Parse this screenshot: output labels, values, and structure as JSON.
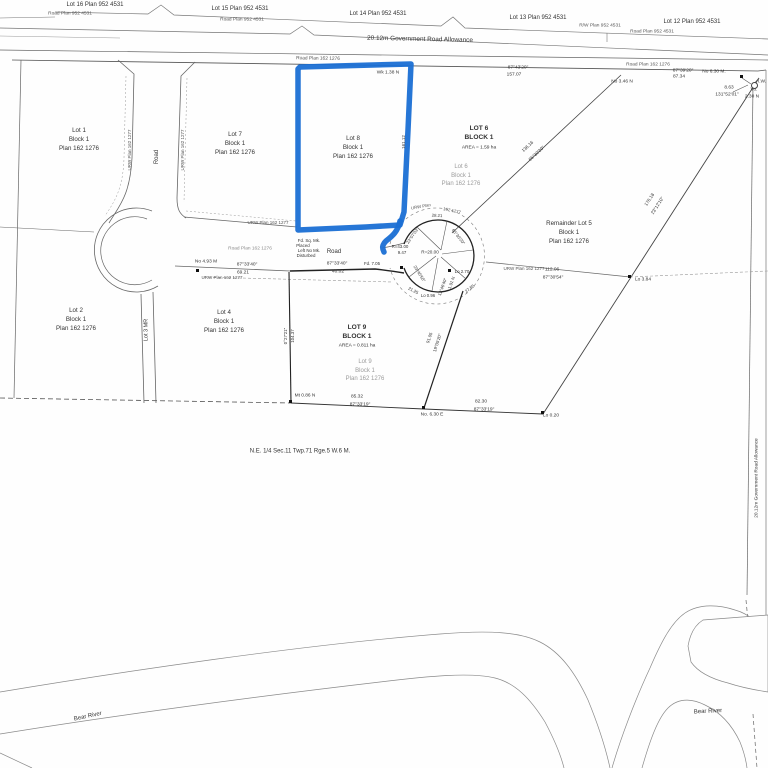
{
  "map_type": "subdivision survey plan",
  "highlight_color": "#1a6fd4",
  "line_color": "#555555",
  "faded_text_color": "#9b9b9b",
  "parcels": [
    {
      "key": "lot-1",
      "x": 79,
      "y": 140,
      "s": 6.2,
      "lines": [
        "Lot 1",
        "Block 1",
        "Plan 162 1276"
      ]
    },
    {
      "key": "lot-7",
      "x": 235,
      "y": 144,
      "s": 6.2,
      "lines": [
        "Lot 7",
        "Block 1",
        "Plan 162 1276"
      ]
    },
    {
      "key": "lot-8-highlighted",
      "x": 353,
      "y": 148,
      "s": 6.2,
      "lines": [
        "Lot 8",
        "Block 1",
        "Plan 162 1276"
      ]
    },
    {
      "key": "lot-6-bold",
      "x": 479,
      "y": 133,
      "s": 6.6,
      "bold": true,
      "lines": [
        "LOT 6",
        "BLOCK 1"
      ]
    },
    {
      "key": "lot-6-faded",
      "x": 461,
      "y": 176,
      "s": 6,
      "c": "#9b9b9b",
      "lines": [
        "Lot 6",
        "Block 1",
        "Plan 162 1276"
      ]
    },
    {
      "key": "remainder-lot-5",
      "x": 569,
      "y": 233,
      "s": 6.2,
      "lines": [
        "Remainder Lot 5",
        "Block 1",
        "Plan 162 1276"
      ]
    },
    {
      "key": "lot-2",
      "x": 76,
      "y": 320,
      "s": 6.2,
      "lines": [
        "Lot 2",
        "Block 1",
        "Plan 162 1276"
      ]
    },
    {
      "key": "lot-4",
      "x": 224,
      "y": 322,
      "s": 6.2,
      "lines": [
        "Lot 4",
        "Block 1",
        "Plan 162 1276"
      ]
    },
    {
      "key": "lot-9-bold",
      "x": 357,
      "y": 332,
      "s": 6.6,
      "bold": true,
      "lines": [
        "LOT 9",
        "BLOCK 1"
      ]
    },
    {
      "key": "lot-9-faded",
      "x": 365,
      "y": 371,
      "s": 6,
      "c": "#9b9b9b",
      "lines": [
        "Lot 9",
        "Block 1",
        "Plan 162 1276"
      ]
    },
    {
      "key": "quarter-section-label",
      "x": 300,
      "y": 452,
      "s": 6,
      "lines": [
        "N.E. 1/4 Sec.11 Twp.71 Rge.5 W.6 M."
      ]
    },
    {
      "key": "bear-river-left",
      "x": 88,
      "y": 717,
      "s": 6,
      "r": -12,
      "lines": [
        "Bear River"
      ]
    },
    {
      "key": "bear-river-right",
      "x": 708,
      "y": 712,
      "s": 6,
      "r": -3,
      "lines": [
        "Bear River"
      ]
    }
  ],
  "annotations": [
    {
      "n": "top-lot-label",
      "t": "Lot 16 Plan 952 4531",
      "x": 95,
      "y": 5,
      "s": 6
    },
    {
      "n": "top-lot-label",
      "t": "Lot 15 Plan 952 4531",
      "x": 240,
      "y": 9,
      "s": 6
    },
    {
      "n": "top-lot-label",
      "t": "Lot 14 Plan 952 4531",
      "x": 378,
      "y": 14,
      "s": 6
    },
    {
      "n": "top-lot-label",
      "t": "Lot 13 Plan 952 4531",
      "x": 538,
      "y": 18,
      "s": 6
    },
    {
      "n": "top-lot-label",
      "t": "Lot 12 Plan 952 4531",
      "x": 692,
      "y": 22,
      "s": 6
    },
    {
      "n": "road-plan-label",
      "t": "Road Plan 952 4531",
      "x": 70,
      "y": 15,
      "s": 4.8,
      "c": "#555"
    },
    {
      "n": "road-plan-label",
      "t": "Road Plan 952 4531",
      "x": 242,
      "y": 21,
      "s": 4.8,
      "c": "#555"
    },
    {
      "n": "road-plan-label",
      "t": "R/W Plan 952 4531",
      "x": 600,
      "y": 27,
      "s": 4.8,
      "c": "#555"
    },
    {
      "n": "road-plan-label",
      "t": "Road Plan 952 4531",
      "x": 652,
      "y": 33,
      "s": 4.8,
      "c": "#555"
    },
    {
      "n": "road-allowance-label",
      "t": "20.12m Government Road Allowance",
      "x": 420,
      "y": 40,
      "s": 6.4,
      "r": 1.2
    },
    {
      "n": "road-plan-label",
      "t": "Road Plan 162 1276",
      "x": 318,
      "y": 60,
      "s": 4.8,
      "c": "#555",
      "r": 1
    },
    {
      "n": "survey-note",
      "t": "Wk 1.38 N",
      "x": 388,
      "y": 74,
      "s": 4.8
    },
    {
      "n": "bearing",
      "t": "87°43'20\"",
      "x": 518,
      "y": 69,
      "s": 4.8
    },
    {
      "n": "distance",
      "t": "157.07",
      "x": 514,
      "y": 76,
      "s": 4.8
    },
    {
      "n": "road-plan-label",
      "t": "Road Plan 162 1276",
      "x": 648,
      "y": 66,
      "s": 4.8,
      "c": "#555"
    },
    {
      "n": "bearing",
      "t": "87°39'20\"",
      "x": 683,
      "y": 72,
      "s": 4.8
    },
    {
      "n": "distance",
      "t": "87.34",
      "x": 679,
      "y": 78,
      "s": 4.8
    },
    {
      "n": "survey-note",
      "t": "No 3.46 N",
      "x": 622,
      "y": 83,
      "s": 4.8
    },
    {
      "n": "survey-note",
      "t": "No 6.30 M.",
      "x": 714,
      "y": 73,
      "s": 4.8
    },
    {
      "n": "distance",
      "t": "8.63",
      "x": 729,
      "y": 89,
      "s": 4.8
    },
    {
      "n": "bearing",
      "t": "131°52'01\"",
      "x": 727,
      "y": 96,
      "s": 4.8
    },
    {
      "n": "survey-note",
      "t": "I.W.",
      "x": 762,
      "y": 83,
      "s": 4.8
    },
    {
      "n": "survey-note",
      "t": "Vo.",
      "x": 754,
      "y": 91,
      "s": 4.8
    },
    {
      "n": "survey-note",
      "t": "2.30 N",
      "x": 752,
      "y": 98,
      "s": 4.8
    },
    {
      "n": "road-label",
      "t": "Road",
      "x": 157,
      "y": 157,
      "s": 6,
      "r": -90
    },
    {
      "n": "urw-label",
      "t": "URW Plan 162 1277",
      "x": 130,
      "y": 150,
      "s": 4.5,
      "r": -90,
      "c": "#555"
    },
    {
      "n": "urw-label",
      "t": "URW Plan 162 1277",
      "x": 183,
      "y": 150,
      "s": 4.5,
      "r": -90,
      "c": "#555"
    },
    {
      "n": "distance",
      "t": "161.12",
      "x": 404,
      "y": 142,
      "s": 4.5,
      "r": -90
    },
    {
      "n": "urw-label",
      "t": "URW Plan 162 1277",
      "x": 268,
      "y": 223,
      "s": 4.5,
      "c": "#555"
    },
    {
      "n": "road-plan-label",
      "t": "Road Plan 162 1276",
      "x": 250,
      "y": 250,
      "s": 4.8,
      "c": "#8a8a8a"
    },
    {
      "n": "road-label",
      "t": "Road",
      "x": 334,
      "y": 252,
      "s": 6
    },
    {
      "n": "survey-note",
      "t": "Fd. Sq. Mk.",
      "x": 309,
      "y": 241,
      "s": 4.4
    },
    {
      "n": "survey-note",
      "t": "Placed",
      "x": 303,
      "y": 246,
      "s": 4.4
    },
    {
      "n": "survey-note",
      "t": "Left No Mk.",
      "x": 309,
      "y": 251,
      "s": 4.4
    },
    {
      "n": "survey-note",
      "t": "Disturbed",
      "x": 306,
      "y": 256,
      "s": 4.4
    },
    {
      "n": "survey-note",
      "t": "No 4.93 M",
      "x": 206,
      "y": 263,
      "s": 4.8
    },
    {
      "n": "bearing",
      "t": "87°33'40\"",
      "x": 247,
      "y": 266,
      "s": 4.8
    },
    {
      "n": "distance",
      "t": "69.21",
      "x": 243,
      "y": 274,
      "s": 4.8
    },
    {
      "n": "urw-label",
      "t": "URW Plan 162 1277",
      "x": 222,
      "y": 278,
      "s": 4.5,
      "c": "#555"
    },
    {
      "n": "bearing",
      "t": "87°33'40\"",
      "x": 337,
      "y": 265,
      "s": 4.8
    },
    {
      "n": "distance",
      "t": "40.02",
      "x": 338,
      "y": 273,
      "s": 4.8
    },
    {
      "n": "survey-note",
      "t": "Fd. 7.05",
      "x": 372,
      "y": 264,
      "s": 4.4
    },
    {
      "n": "radius-label",
      "t": "R=43.00",
      "x": 400,
      "y": 247,
      "s": 4.4
    },
    {
      "n": "distance",
      "t": "9.47",
      "x": 402,
      "y": 253,
      "s": 4.4
    },
    {
      "n": "urw-label",
      "t": "URW Plan",
      "x": 421,
      "y": 207,
      "s": 4.3,
      "r": -10,
      "c": "#555"
    },
    {
      "n": "urw-label",
      "t": "162 1277",
      "x": 452,
      "y": 211,
      "s": 4.3,
      "r": 12,
      "c": "#555"
    },
    {
      "n": "distance",
      "t": "28.21",
      "x": 437,
      "y": 216,
      "s": 4.3,
      "r": 3
    },
    {
      "n": "bearing",
      "t": "23°07'03\"",
      "x": 413,
      "y": 236,
      "s": 4.3,
      "r": -55
    },
    {
      "n": "bearing",
      "t": "65°30'20\"",
      "x": 458,
      "y": 237,
      "s": 4.3,
      "r": 52
    },
    {
      "n": "radius-label",
      "t": "R=20.00",
      "x": 430,
      "y": 253,
      "s": 4.6
    },
    {
      "n": "survey-note",
      "t": "Lo 2.70",
      "x": 462,
      "y": 272,
      "s": 4.4
    },
    {
      "n": "bearing",
      "t": "23°40'50\"",
      "x": 419,
      "y": 274,
      "s": 4.3,
      "r": 58
    },
    {
      "n": "bearing",
      "t": "12°46'40\"",
      "x": 443,
      "y": 287,
      "s": 4.3,
      "r": -70
    },
    {
      "n": "survey-note",
      "t": "1.91 N",
      "x": 452,
      "y": 283,
      "s": 4.3,
      "r": -70
    },
    {
      "n": "distance",
      "t": "21.25",
      "x": 413,
      "y": 291,
      "s": 4.3,
      "r": 28
    },
    {
      "n": "distance",
      "t": "27.85",
      "x": 470,
      "y": 289,
      "s": 4.3,
      "r": -38
    },
    {
      "n": "survey-note",
      "t": "Lo 0.96",
      "x": 428,
      "y": 296,
      "s": 4.3
    },
    {
      "n": "urw-label",
      "t": "URW Plan 162 1277",
      "x": 524,
      "y": 269,
      "s": 4.5,
      "c": "#555"
    },
    {
      "n": "distance",
      "t": "112.06",
      "x": 552,
      "y": 271,
      "s": 4.8
    },
    {
      "n": "bearing",
      "t": "87°30'54\"",
      "x": 553,
      "y": 279,
      "s": 4.8
    },
    {
      "n": "survey-note",
      "t": "Lo 3.84",
      "x": 643,
      "y": 281,
      "s": 4.8
    },
    {
      "n": "distance",
      "t": "136.16",
      "x": 528,
      "y": 147,
      "s": 4.6,
      "r": -43
    },
    {
      "n": "bearing",
      "t": "65°30'20\"",
      "x": 537,
      "y": 154,
      "s": 4.6,
      "r": -43
    },
    {
      "n": "distance",
      "t": "176.18",
      "x": 650,
      "y": 200,
      "s": 4.6,
      "r": -57
    },
    {
      "n": "bearing",
      "t": "23°12'10\"",
      "x": 658,
      "y": 206,
      "s": 4.6,
      "r": -57
    },
    {
      "n": "bearing",
      "t": "0°27'21\"",
      "x": 286,
      "y": 336,
      "s": 4.4,
      "r": -90
    },
    {
      "n": "distance",
      "t": "104.37",
      "x": 293,
      "y": 336,
      "s": 4.4,
      "r": -90
    },
    {
      "n": "distance",
      "t": "91.05",
      "x": 430,
      "y": 338,
      "s": 4.4,
      "r": -72
    },
    {
      "n": "bearing",
      "t": "19°05'20\"",
      "x": 438,
      "y": 343,
      "s": 4.4,
      "r": -72
    },
    {
      "n": "area-label",
      "t": "AREA = 1.59 ha",
      "x": 479,
      "y": 149,
      "s": 4.8
    },
    {
      "n": "area-label",
      "t": "AREA = 0.811 ha",
      "x": 357,
      "y": 347,
      "s": 4.8
    },
    {
      "n": "survey-note",
      "t": "Mt 0.86 N",
      "x": 305,
      "y": 397,
      "s": 4.8
    },
    {
      "n": "distance",
      "t": "85.32",
      "x": 357,
      "y": 398,
      "s": 4.8
    },
    {
      "n": "bearing",
      "t": "87°33'19\"",
      "x": 360,
      "y": 406,
      "s": 4.8
    },
    {
      "n": "survey-note",
      "t": "No. 6.30 E",
      "x": 432,
      "y": 416,
      "s": 4.8
    },
    {
      "n": "distance",
      "t": "82.30",
      "x": 481,
      "y": 403,
      "s": 4.8
    },
    {
      "n": "bearing",
      "t": "87°33'19\"",
      "x": 484,
      "y": 411,
      "s": 4.8
    },
    {
      "n": "survey-note",
      "t": "Lo 0.20",
      "x": 551,
      "y": 417,
      "s": 4.8
    },
    {
      "n": "mr-lot-label",
      "t": "Lot 3 MR",
      "x": 147,
      "y": 330,
      "s": 5.5,
      "r": -90
    },
    {
      "n": "road-allowance-label",
      "t": "20.12m Government Road Allowance",
      "x": 758,
      "y": 478,
      "s": 4.8,
      "r": -90
    }
  ],
  "markers": [
    {
      "k": "sq",
      "x": 742,
      "y": 77
    },
    {
      "k": "circle",
      "x": 753,
      "y": 84
    },
    {
      "k": "sq",
      "x": 198,
      "y": 271
    },
    {
      "k": "sq",
      "x": 291,
      "y": 402
    },
    {
      "k": "sq",
      "x": 424,
      "y": 408
    },
    {
      "k": "sq",
      "x": 543,
      "y": 413
    },
    {
      "k": "sq",
      "x": 630,
      "y": 277
    },
    {
      "k": "sq",
      "x": 450,
      "y": 271
    },
    {
      "k": "sq",
      "x": 402,
      "y": 268
    }
  ]
}
